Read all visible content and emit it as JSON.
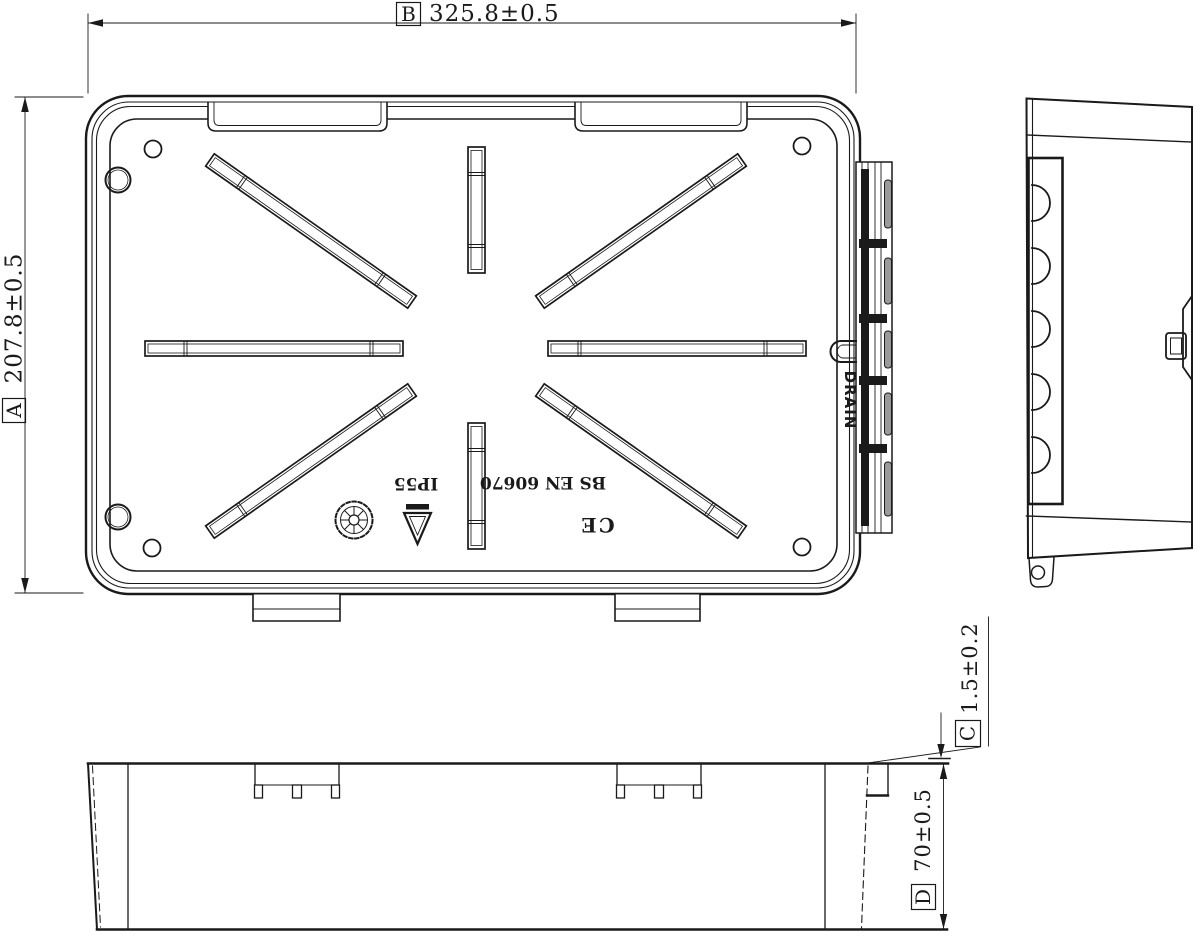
{
  "drawing": {
    "colors": {
      "line": "#1a1a1a",
      "background": "#ffffff",
      "knockout_fill": "#9a9a9a"
    },
    "dimensions": {
      "width": {
        "label": "B",
        "value": "325.8±0.5"
      },
      "height": {
        "label": "A",
        "value": "207.8±0.5"
      },
      "lid_lip": {
        "label": "C",
        "value": "1.5±0.2"
      },
      "depth": {
        "label": "D",
        "value": "70±0.5"
      }
    },
    "markings": {
      "ip_rating": "IP55",
      "standard": "BS EN 60670",
      "ce_mark": "CE",
      "drain_label": "DRAIN"
    }
  }
}
